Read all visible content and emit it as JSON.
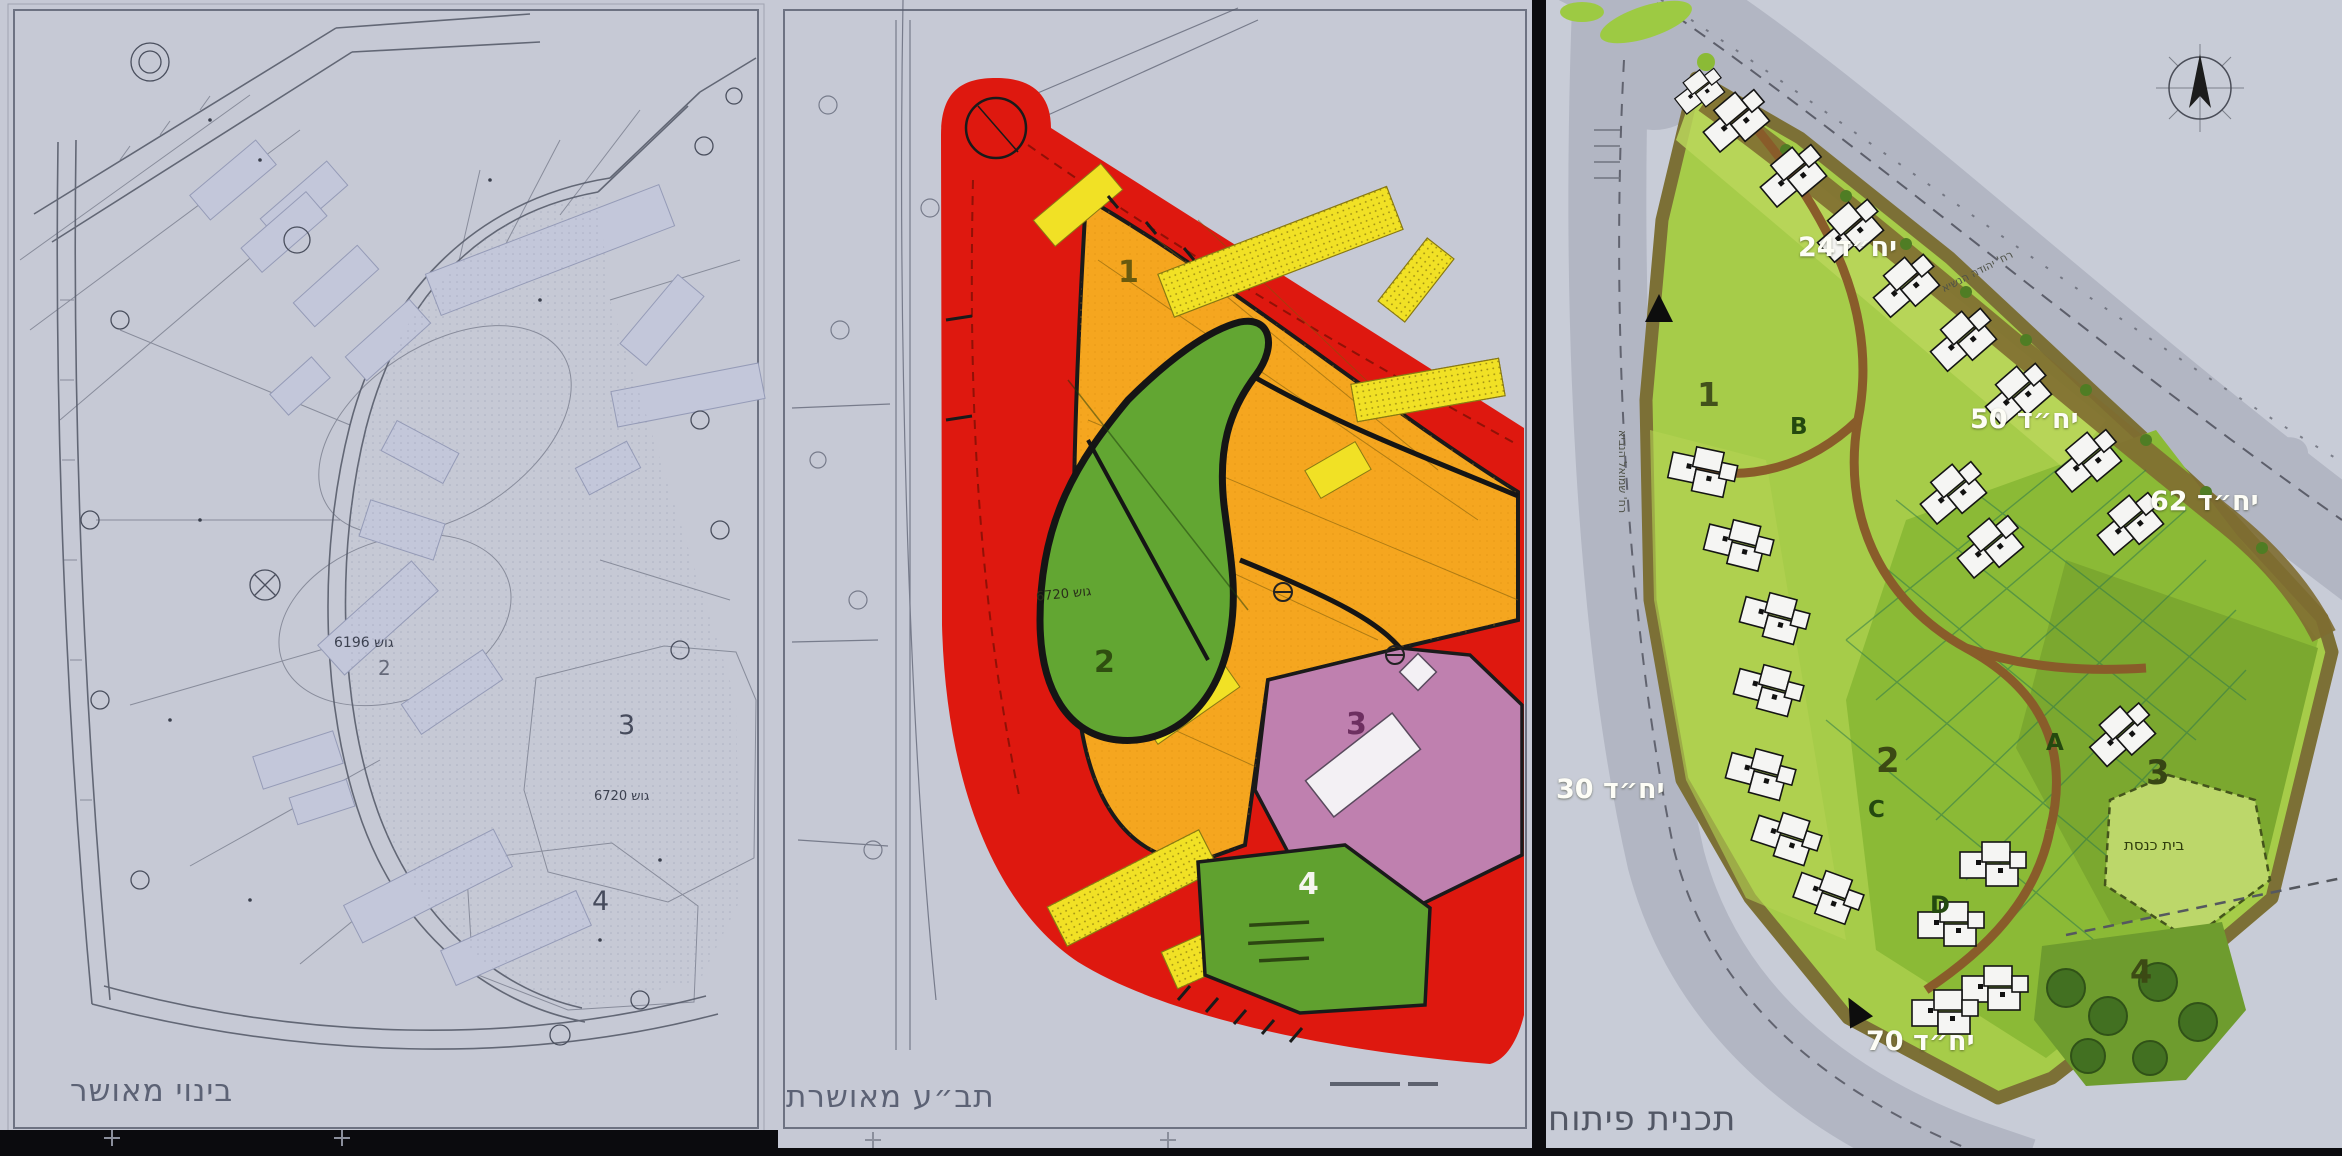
{
  "panels": {
    "left": {
      "title": "בינוי מאושר",
      "zone2": "2",
      "zone3": "3",
      "zone4": "4",
      "block_a": "גוש 6196",
      "block_b": "גוש 6720"
    },
    "middle": {
      "title": "תב״ע מאושרת",
      "zone1": "1",
      "zone2": "2",
      "zone3": "3",
      "zone4": "4",
      "block": "גוש 6720"
    },
    "right": {
      "title": "תכנית פיתוח",
      "units": {
        "u24": "יח״ד24",
        "u50": "יח״ד 50",
        "u62": "יח״ד 62",
        "u30": "יח״ד 30",
        "u70": "יח״ד 70"
      },
      "zones": {
        "z1": "1",
        "z2": "2",
        "z3": "3",
        "z4": "4"
      },
      "buildings": {
        "a": "A",
        "b": "B",
        "c": "C",
        "d": "D"
      },
      "synagogue": "בית כנסת",
      "street_top": "רח' יהודה הנשיא",
      "street_left": "רח' שמואל הנביא"
    }
  },
  "colors": {
    "background": "#c6c9d5",
    "road_red": "#e3170d",
    "residential_orange": "#f7a61b",
    "building_yellow": "#f2e11f",
    "open_green": "#61a72f",
    "public_pink": "#c07fb0",
    "plan_light_green": "#a5cd45",
    "plan_mid_green": "#8abb33"
  }
}
